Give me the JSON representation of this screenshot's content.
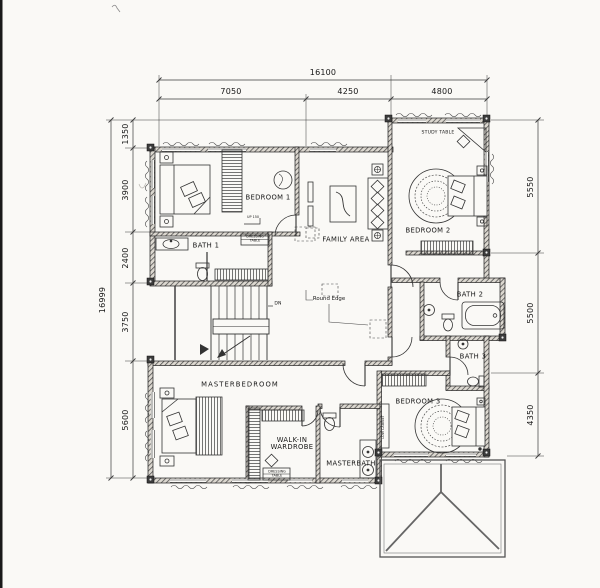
{
  "dimensions": {
    "top_total": "16100",
    "top": [
      "7050",
      "4250",
      "4800"
    ],
    "left_total": "16999",
    "left": [
      "1350",
      "3900",
      "2400",
      "3750",
      "5600"
    ],
    "right": [
      "5550",
      "5500",
      "4350"
    ]
  },
  "rooms": {
    "bedroom1": "BEDROOM 1",
    "family_area": "FAMILY AREA",
    "bedroom2": "BEDROOM 2",
    "bath1": "BATH 1",
    "bath2": "BATH 2",
    "bath3": "BATH 3",
    "masterbedroom": "MASTERBEDROOM",
    "walk_in_wardrobe": "WALK-IN WARDROBE",
    "masterbath": "MASTERBATH",
    "bedroom3": "BEDROOM 3"
  },
  "annotations": {
    "study_table": "STUDY TABLE",
    "round_edge": "Round Edge",
    "up": "UP 150",
    "dn": "DN",
    "dressing_table_1": "DRESSING TABLE",
    "dressing_table_2": "DRESSING TABLE",
    "low_cabinet": "LOW CABINET"
  },
  "ink_color": "#2a2a2a"
}
